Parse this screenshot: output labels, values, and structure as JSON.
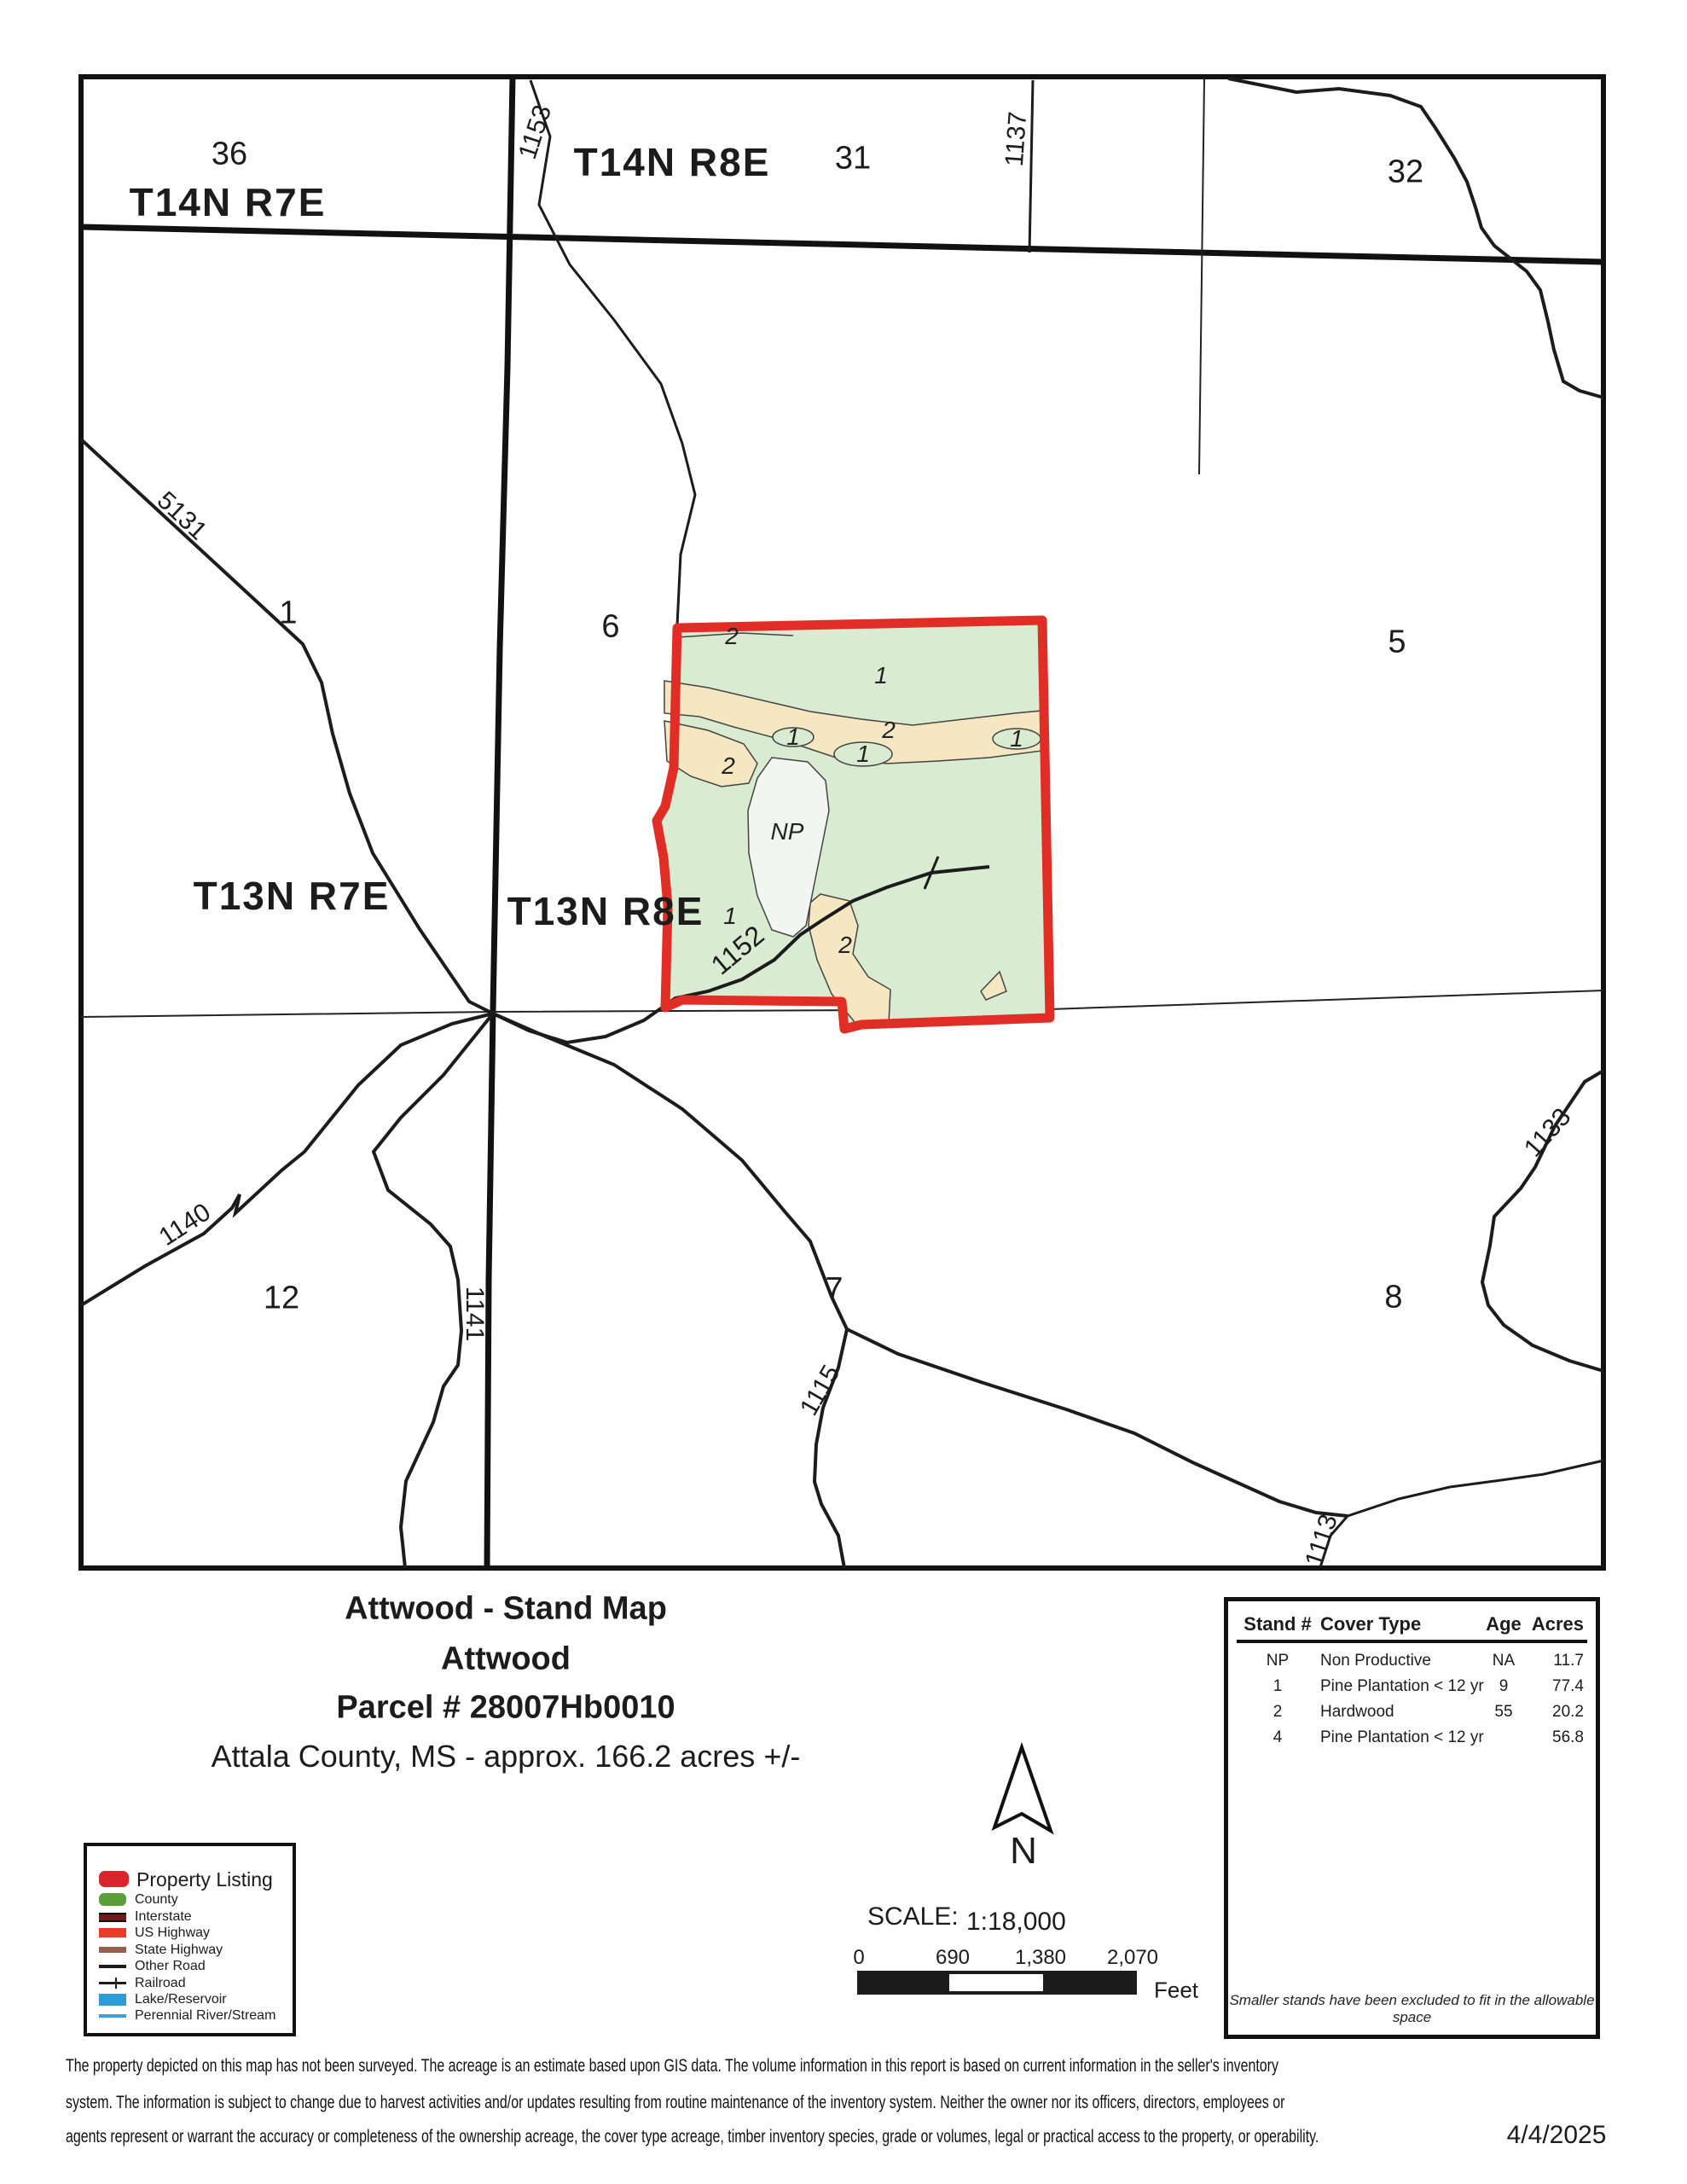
{
  "map": {
    "township_labels": {
      "t14n_r7e": "T14N R7E",
      "t14n_r8e": "T14N R8E",
      "t13n_r7e": "T13N R7E",
      "t13n_r8e": "T13N R8E"
    },
    "sections": {
      "s36": "36",
      "s31": "31",
      "s32": "32",
      "s1": "1",
      "s6": "6",
      "s5": "5",
      "s12": "12",
      "s7": "7",
      "s8": "8"
    },
    "roads": {
      "r1153": "1153",
      "r1137": "1137",
      "r5131": "5131",
      "r1152": "1152",
      "r1140": "1140",
      "r1141": "1141",
      "r1115": "1115",
      "r1133": "1133",
      "r1113": "1113"
    },
    "stands": {
      "top2": "2",
      "top1": "1",
      "left1": "1",
      "mid2": "2",
      "mid1": "1",
      "right1": "1",
      "wedge2": "2",
      "np": "NP",
      "low1": "1",
      "patch2": "2"
    },
    "colors": {
      "property_outline": "#e02d26",
      "pine": "#d9ecd2",
      "hardwood": "#f6e7c3",
      "non_productive": "#f3f5f1",
      "line": "#1c1c1c"
    }
  },
  "title": {
    "line1": "Attwood - Stand Map",
    "line2": "Attwood",
    "line3": "Parcel # 28007Hb0010",
    "line4": "Attala County, MS - approx. 166.2 acres +/-"
  },
  "stand_table": {
    "headers": [
      "Stand #",
      "Cover Type",
      "Age",
      "Acres"
    ],
    "rows": [
      [
        "NP",
        "Non Productive",
        "NA",
        "11.7"
      ],
      [
        "1",
        "Pine Plantation < 12 yr",
        "9",
        "77.4"
      ],
      [
        "2",
        "Hardwood",
        "55",
        "20.2"
      ],
      [
        "4",
        "Pine Plantation < 12 yr",
        "",
        "56.8"
      ]
    ],
    "note": "Smaller stands have been excluded to fit in the allowable space"
  },
  "legend": {
    "items": [
      {
        "label": "Property Listing",
        "color": "#d9252b"
      },
      {
        "label": "County",
        "color": "#5a9e3c"
      },
      {
        "label": "Interstate",
        "color": "#6d1a1d"
      },
      {
        "label": "US Highway",
        "color": "#e63c28"
      },
      {
        "label": "State Highway",
        "color": "#96604f"
      },
      {
        "label": "Other Road",
        "color": "#1b1b1b"
      },
      {
        "label": "Railroad",
        "color": "#1b1b1b"
      },
      {
        "label": "Lake/Reservoir",
        "color": "#2f9cd8"
      },
      {
        "label": "Perennial River/Stream",
        "color": "#3aa2e2"
      }
    ]
  },
  "north": {
    "label": "N"
  },
  "scale_bar": {
    "label": "SCALE:",
    "ratio": "1:18,000",
    "ticks": [
      "0",
      "690",
      "1,380",
      "2,070"
    ],
    "unit": "Feet"
  },
  "footer": {
    "line1": "The property depicted on this map has not been surveyed.  The acreage is an estimate based upon GIS data.  The volume information in this report is based on current information in the seller's inventory",
    "line2": "system.  The information is subject to change due to harvest activities and/or updates resulting from routine maintenance of the inventory system.  Neither the owner nor its officers, directors, employees or",
    "line3": "agents represent or warrant the accuracy or completeness of the ownership acreage, the cover type acreage, timber inventory species, grade or volumes, legal or practical access to the property, or operability.",
    "date": "4/4/2025"
  }
}
